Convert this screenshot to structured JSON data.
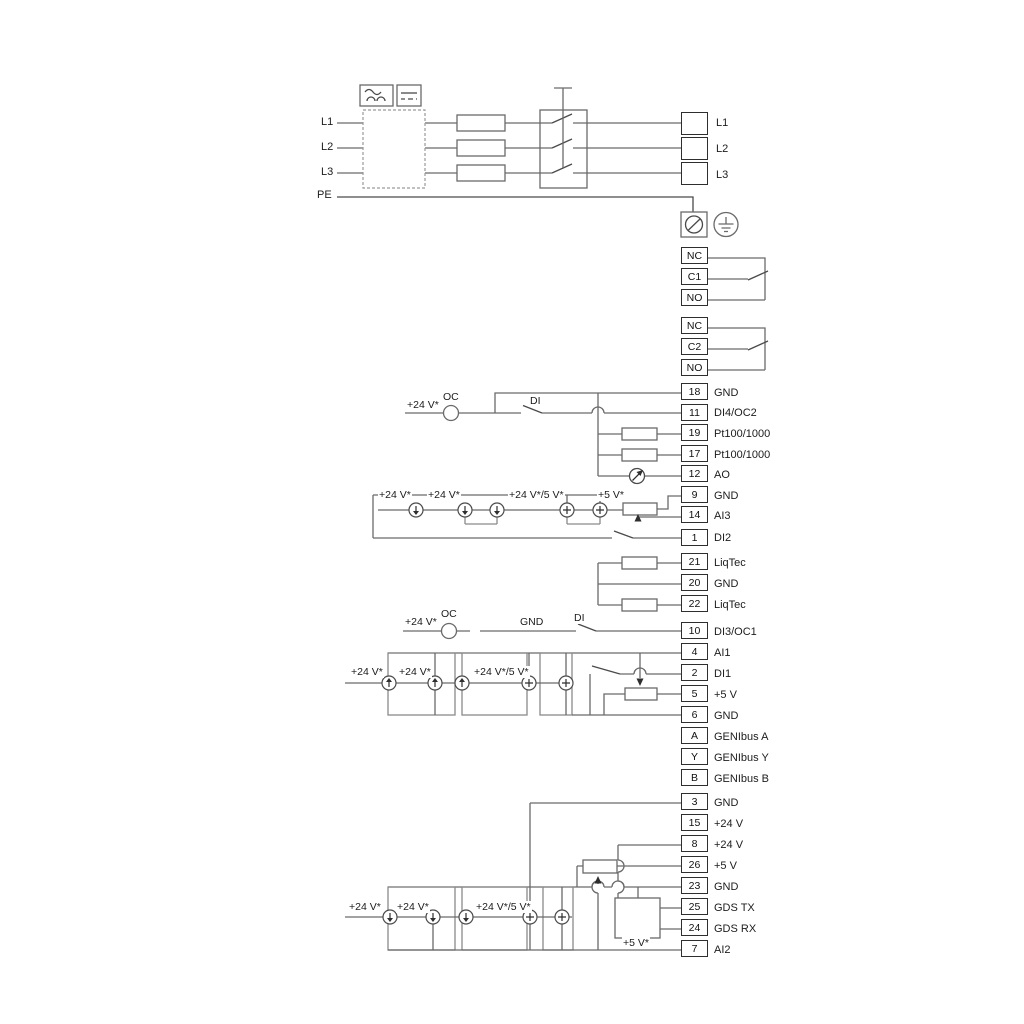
{
  "diagram": {
    "mains": {
      "input_lines": [
        "L1",
        "L2",
        "L3",
        "PE"
      ],
      "terminal_labels": [
        "L1",
        "L2",
        "L3"
      ]
    },
    "relay1": {
      "rows": [
        "NC",
        "C1",
        "NO"
      ]
    },
    "relay2": {
      "rows": [
        "NC",
        "C2",
        "NO"
      ]
    },
    "io_top": {
      "rows": [
        {
          "num": "18",
          "label": "GND"
        },
        {
          "num": "11",
          "label": "DI4/OC2"
        },
        {
          "num": "19",
          "label": "Pt100/1000"
        },
        {
          "num": "17",
          "label": "Pt100/1000"
        },
        {
          "num": "12",
          "label": "AO"
        },
        {
          "num": "9",
          "label": "GND"
        },
        {
          "num": "14",
          "label": "AI3"
        },
        {
          "num": "1",
          "label": "DI2"
        }
      ]
    },
    "liqtec": {
      "rows": [
        {
          "num": "21",
          "label": "LiqTec"
        },
        {
          "num": "20",
          "label": "GND"
        },
        {
          "num": "22",
          "label": "LiqTec"
        }
      ]
    },
    "io_mid": {
      "rows": [
        {
          "num": "10",
          "label": "DI3/OC1"
        },
        {
          "num": "4",
          "label": "AI1"
        },
        {
          "num": "2",
          "label": "DI1"
        },
        {
          "num": "5",
          "label": "+5 V"
        },
        {
          "num": "6",
          "label": "GND"
        },
        {
          "num": "A",
          "label": "GENIbus A"
        },
        {
          "num": "Y",
          "label": "GENIbus Y"
        },
        {
          "num": "B",
          "label": "GENIbus B"
        }
      ]
    },
    "io_bottom": {
      "rows": [
        {
          "num": "3",
          "label": "GND"
        },
        {
          "num": "15",
          "label": "+24 V"
        },
        {
          "num": "8",
          "label": "+24 V"
        },
        {
          "num": "26",
          "label": "+5 V"
        },
        {
          "num": "23",
          "label": "GND"
        },
        {
          "num": "25",
          "label": "GDS TX"
        },
        {
          "num": "24",
          "label": "GDS RX"
        },
        {
          "num": "7",
          "label": "AI2"
        }
      ]
    },
    "di4_row": {
      "supply": "+24 V*",
      "oc": "OC",
      "di": "DI"
    },
    "ai3_row": {
      "s24": "+24 V*",
      "s24b": "+24 V*",
      "s245": "+24 V*/5 V*",
      "s5": "+5 V*"
    },
    "di3_row": {
      "supply": "+24 V*",
      "oc": "OC",
      "gnd": "GND",
      "di": "DI"
    },
    "ai1_row": {
      "s24": "+24 V*",
      "s24b": "+24 V*",
      "s245": "+24 V*/5 V*"
    },
    "ai2_row": {
      "s24": "+24 V*",
      "s24b": "+24 V*",
      "s245": "+24 V*/5 V*",
      "s5": "+5 V*"
    },
    "colors": {
      "wire": "#6a6a6a",
      "dark": "#2e2e2e"
    }
  }
}
